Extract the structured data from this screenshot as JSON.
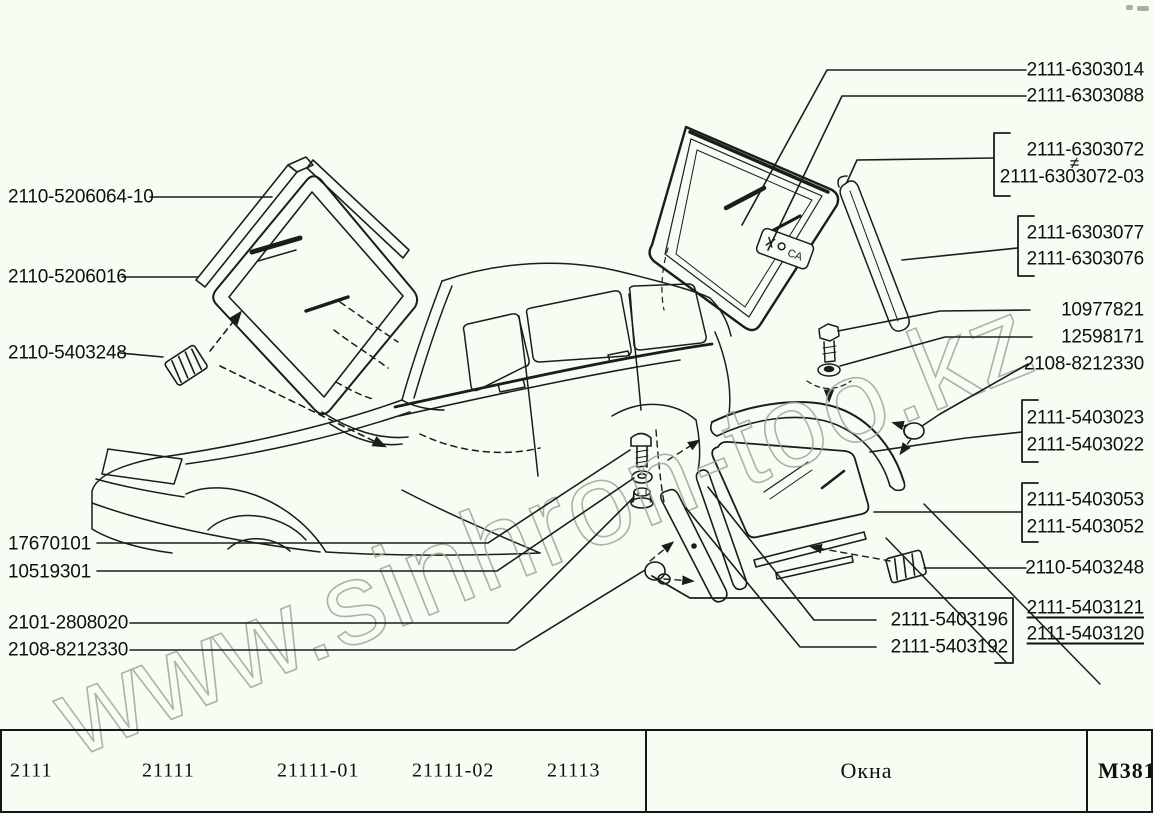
{
  "watermark": {
    "text": "www.sinhron-too.kz",
    "color": "#9aa89a"
  },
  "colors": {
    "background": "#f6fdf3",
    "ink": "#1c1c1c"
  },
  "glass_stamp": "СА",
  "labels": {
    "left": [
      "2110-5206064-10",
      "2110-5206016",
      "2110-5403248",
      "17670101",
      "10519301",
      "2101-2808020",
      "2108-8212330"
    ],
    "right": {
      "r1": "2111-6303014",
      "r2": "2111-6303088",
      "g72a": "2111-6303072",
      "neq": "≠",
      "g72b": "2111-6303072-03",
      "g77a": "2111-6303077",
      "g77b": "2111-6303076",
      "r3": "10977821",
      "r4": "12598171",
      "r5": "2108-8212330",
      "g23a": "2111-5403023",
      "g23b": "2111-5403022",
      "g53a": "2111-5403053",
      "g53b": "2111-5403052",
      "r6": "2110-5403248",
      "u1": "2111-5403121",
      "u2": "2111-5403120"
    },
    "mid": [
      "2111-5403196",
      "2111-5403192"
    ]
  },
  "footer": {
    "models": [
      "2111",
      "21111",
      "21111-01",
      "21111-02",
      "21113"
    ],
    "section_title": "Окна",
    "sheet_code": "М381"
  }
}
